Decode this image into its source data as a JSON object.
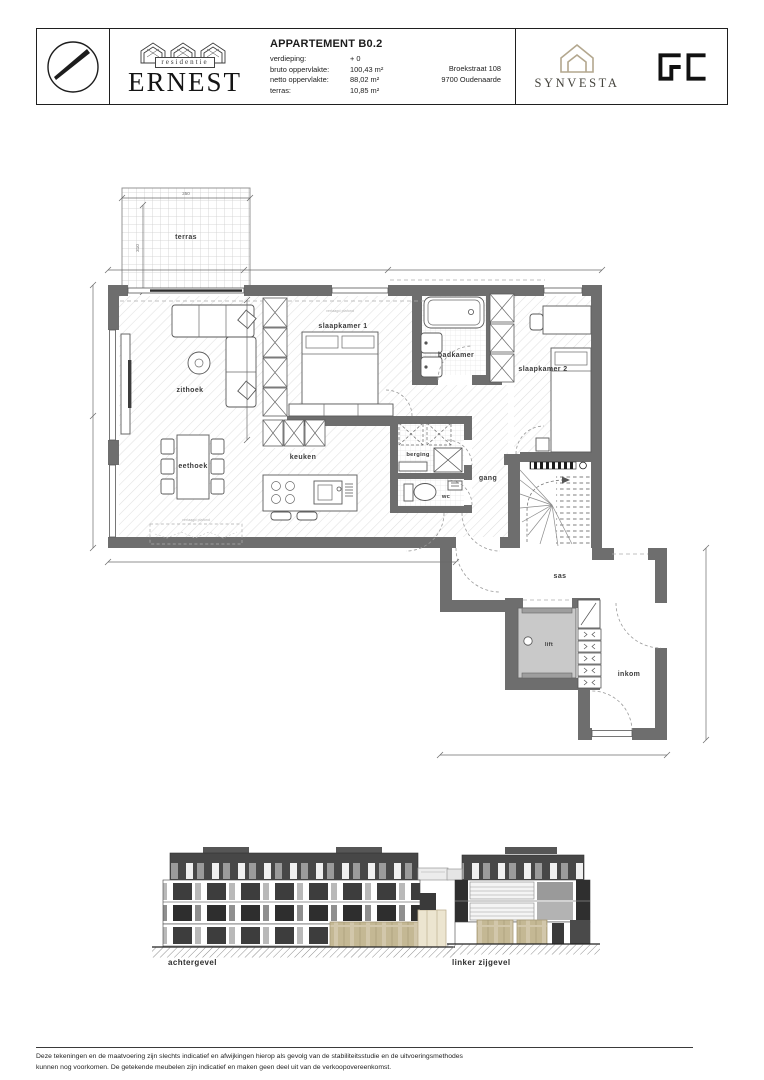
{
  "header": {
    "title": "APPARTEMENT B0.2",
    "fields": [
      {
        "label": "verdieping:",
        "value": "+ 0"
      },
      {
        "label": "bruto oppervlakte:",
        "value": "100,43 m²"
      },
      {
        "label": "netto oppervlakte:",
        "value": "88,02 m²"
      },
      {
        "label": "terras:",
        "value": "10,85 m²"
      }
    ],
    "address": {
      "line1": "Broekstraat 108",
      "line2": "9700 Oudenaarde"
    },
    "residence": {
      "prefix": "residentie",
      "name": "ERNEST"
    },
    "brands": {
      "synvesta": "SYNVESTA",
      "gc": "GC"
    }
  },
  "plan": {
    "rooms": {
      "terras": "terras",
      "zithoek": "zithoek",
      "eethoek": "eethoek",
      "keuken": "keuken",
      "slaapkamer1": "slaapkamer 1",
      "badkamer": "badkamer",
      "slaapkamer2": "slaapkamer 2",
      "berging": "berging",
      "wc": "wc",
      "gang": "gang",
      "sas": "sas",
      "lift": "lift",
      "inkom": "inkom"
    },
    "dimensions": {
      "terras_width": "350",
      "terras_depth": "310"
    },
    "notes": {
      "ceiling": "verlaagd plafond"
    }
  },
  "elevations": {
    "rear": "achtergevel",
    "left": "linker zijgevel"
  },
  "footer": {
    "line1": "Deze tekeningen en de maatvoering zijn slechts indicatief en afwijkingen hierop als gevolg van de stabiliteitsstudie en de uitvoeringsmethodes",
    "line2": "kunnen nog voorkomen. De getekende meubelen zijn indicatief en maken geen deel uit van de verkoopovereenkomst."
  },
  "colors": {
    "wall": "#6e6e6e",
    "accent_tan": "#cdc2a4",
    "brand_tan": "#b3a78e",
    "dark_facade": "#3f3f3f"
  }
}
